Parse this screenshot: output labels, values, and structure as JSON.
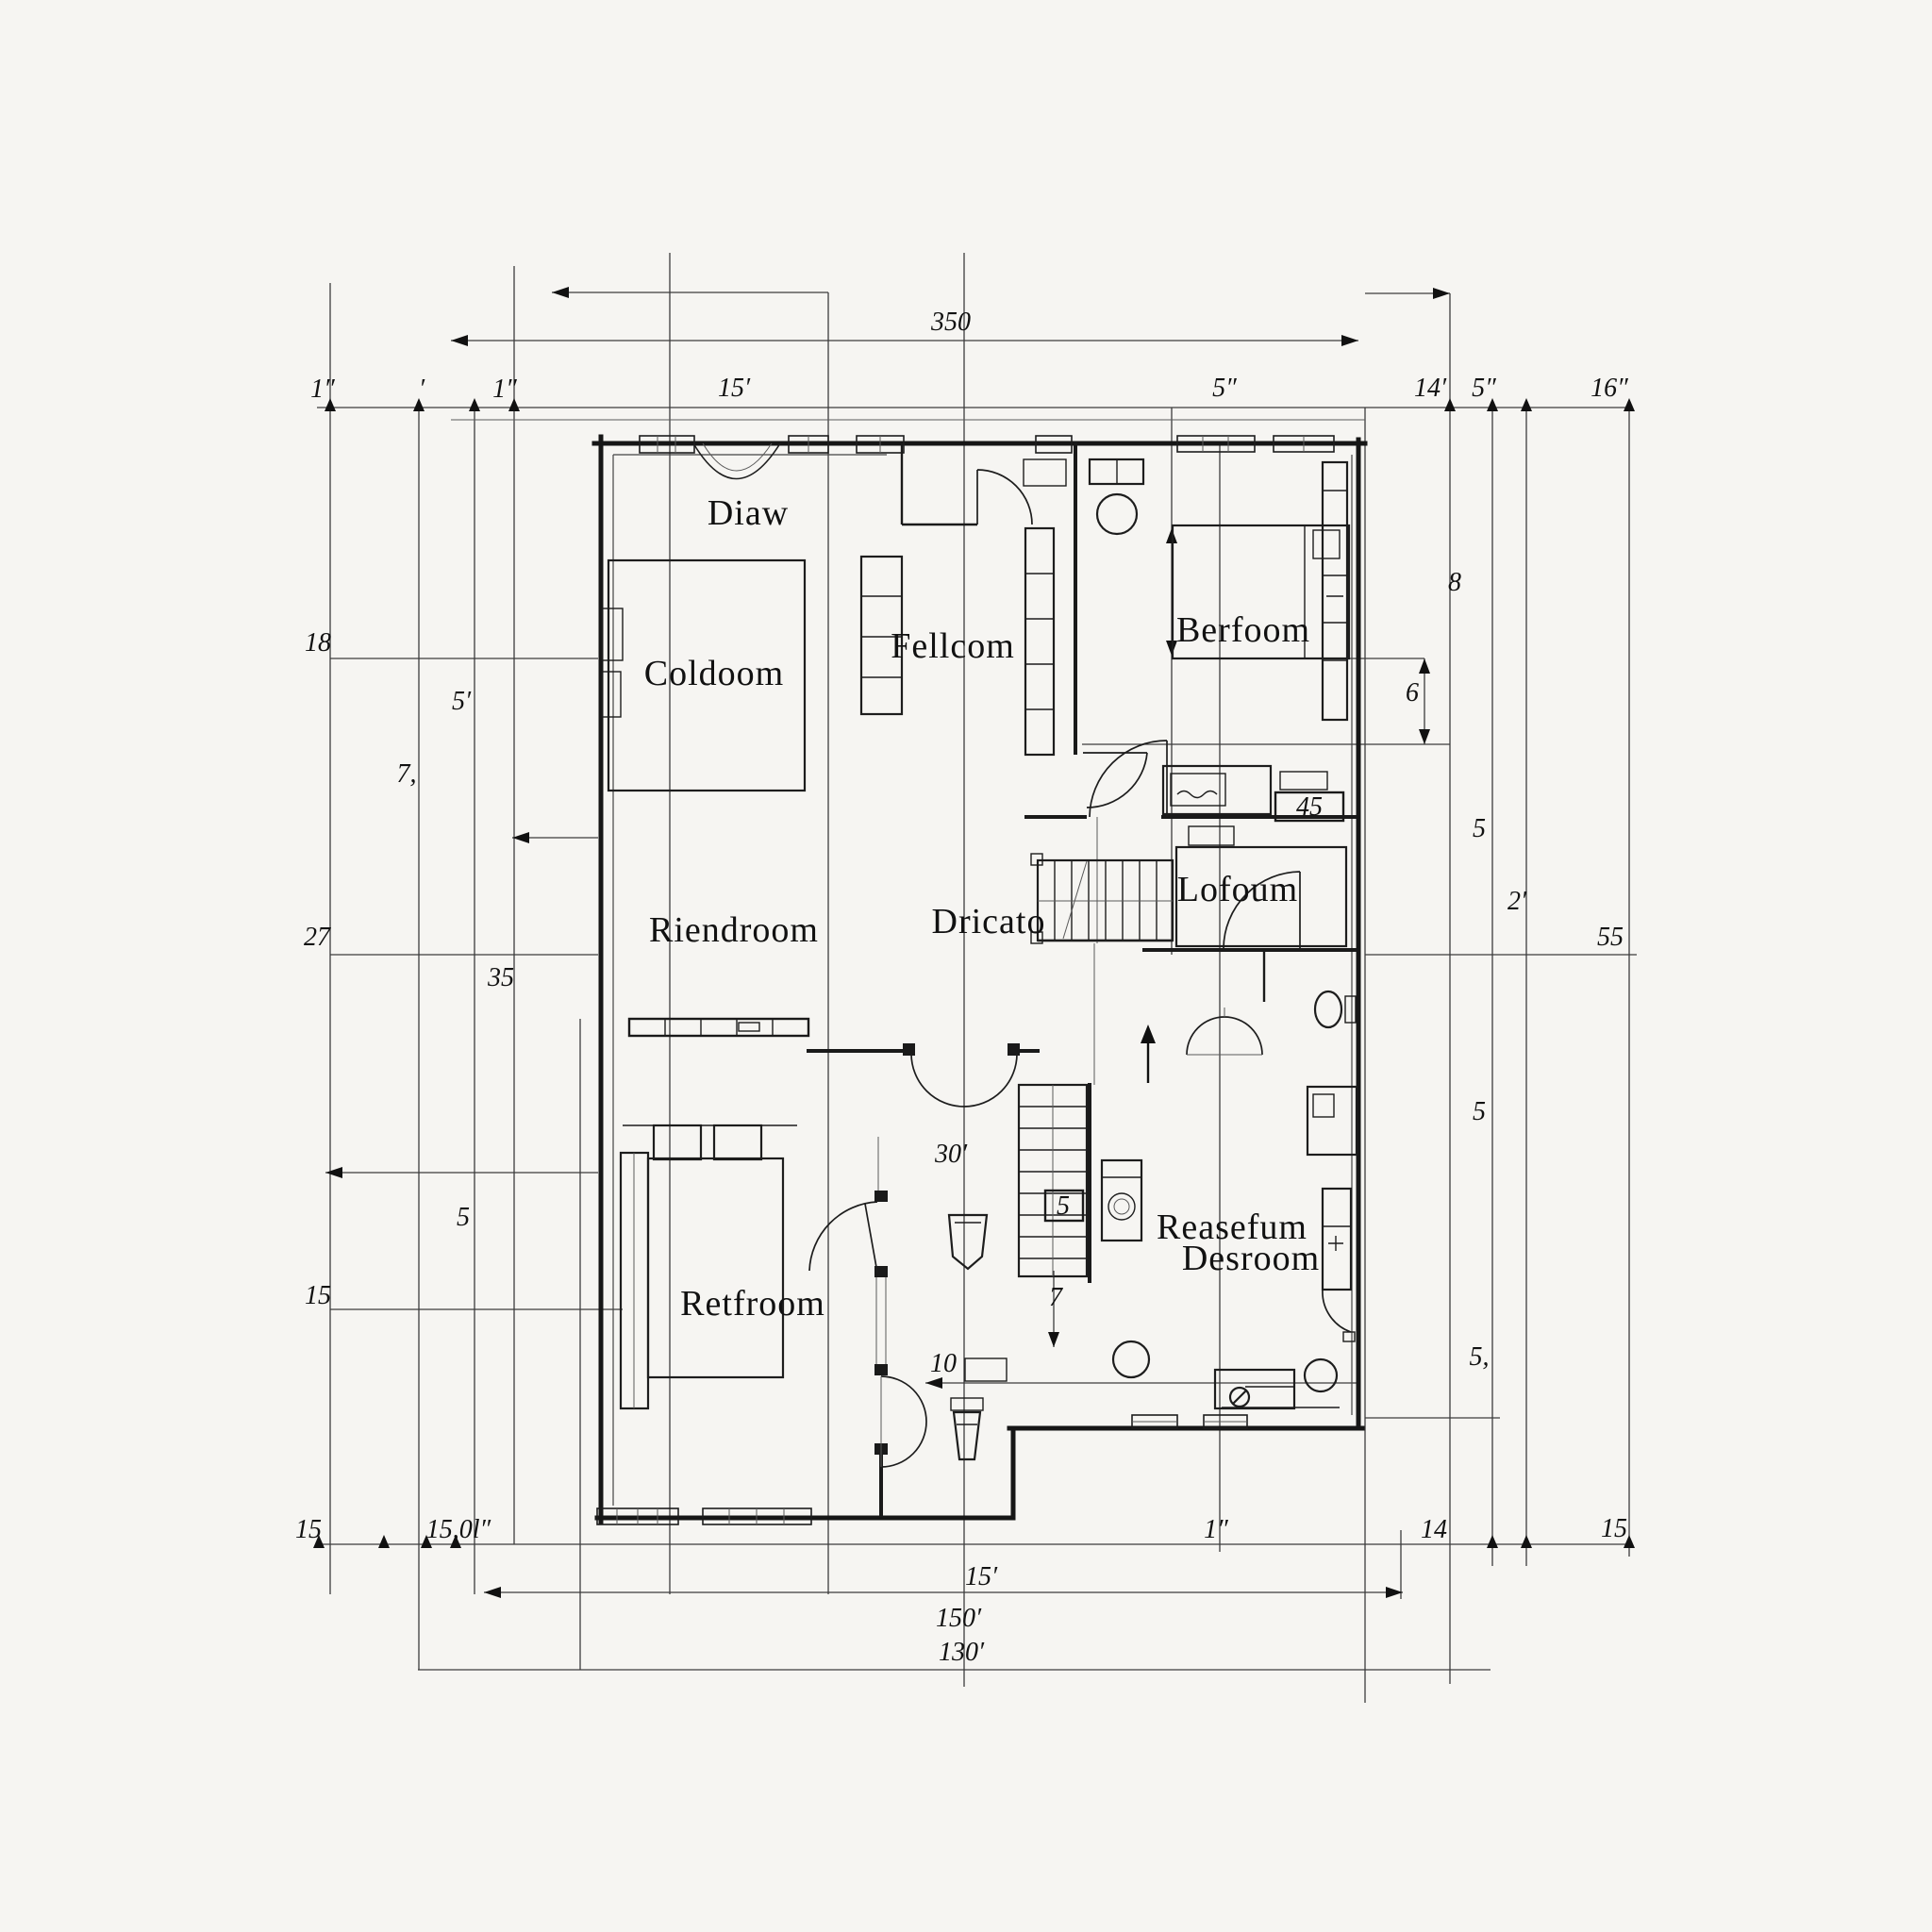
{
  "palette": {
    "background": "#f6f5f2",
    "ink": "#1c1c1c",
    "grid": "#3c3c3c"
  },
  "rooms": [
    {
      "id": "diaw",
      "label": "Diaw"
    },
    {
      "id": "coldoom",
      "label": "Coldoom"
    },
    {
      "id": "fellcom",
      "label": "Fellcom"
    },
    {
      "id": "berfoom",
      "label": "Berfoom"
    },
    {
      "id": "riendroom",
      "label": "Riendroom"
    },
    {
      "id": "dricato",
      "label": "Dricato"
    },
    {
      "id": "lofoum",
      "label": "Lofoum"
    },
    {
      "id": "retfroom",
      "label": "Retfroom"
    },
    {
      "id": "reasefum_line1",
      "label": "Reasefum"
    },
    {
      "id": "reasefum_line2",
      "label": "Desroom"
    }
  ],
  "dims": [
    {
      "t": "1″"
    },
    {
      "t": "′"
    },
    {
      "t": "1″"
    },
    {
      "t": "15′"
    },
    {
      "t": "5″"
    },
    {
      "t": "14′"
    },
    {
      "t": "5″"
    },
    {
      "t": "16″"
    },
    {
      "t": "350"
    },
    {
      "t": "18"
    },
    {
      "t": "5′"
    },
    {
      "t": "7,"
    },
    {
      "t": "27"
    },
    {
      "t": "35"
    },
    {
      "t": "5"
    },
    {
      "t": "15"
    },
    {
      "t": "15"
    },
    {
      "t": "15,0l″"
    },
    {
      "t": "8"
    },
    {
      "t": "6"
    },
    {
      "t": "5"
    },
    {
      "t": "2′"
    },
    {
      "t": "55"
    },
    {
      "t": "5"
    },
    {
      "t": "5,"
    },
    {
      "t": "1″"
    },
    {
      "t": "14"
    },
    {
      "t": "15"
    },
    {
      "t": "15′"
    },
    {
      "t": "150′"
    },
    {
      "t": "130′"
    },
    {
      "t": "30′"
    },
    {
      "t": "10"
    },
    {
      "t": "7"
    }
  ],
  "boxed": [
    {
      "t": "45"
    },
    {
      "t": "5"
    }
  ]
}
